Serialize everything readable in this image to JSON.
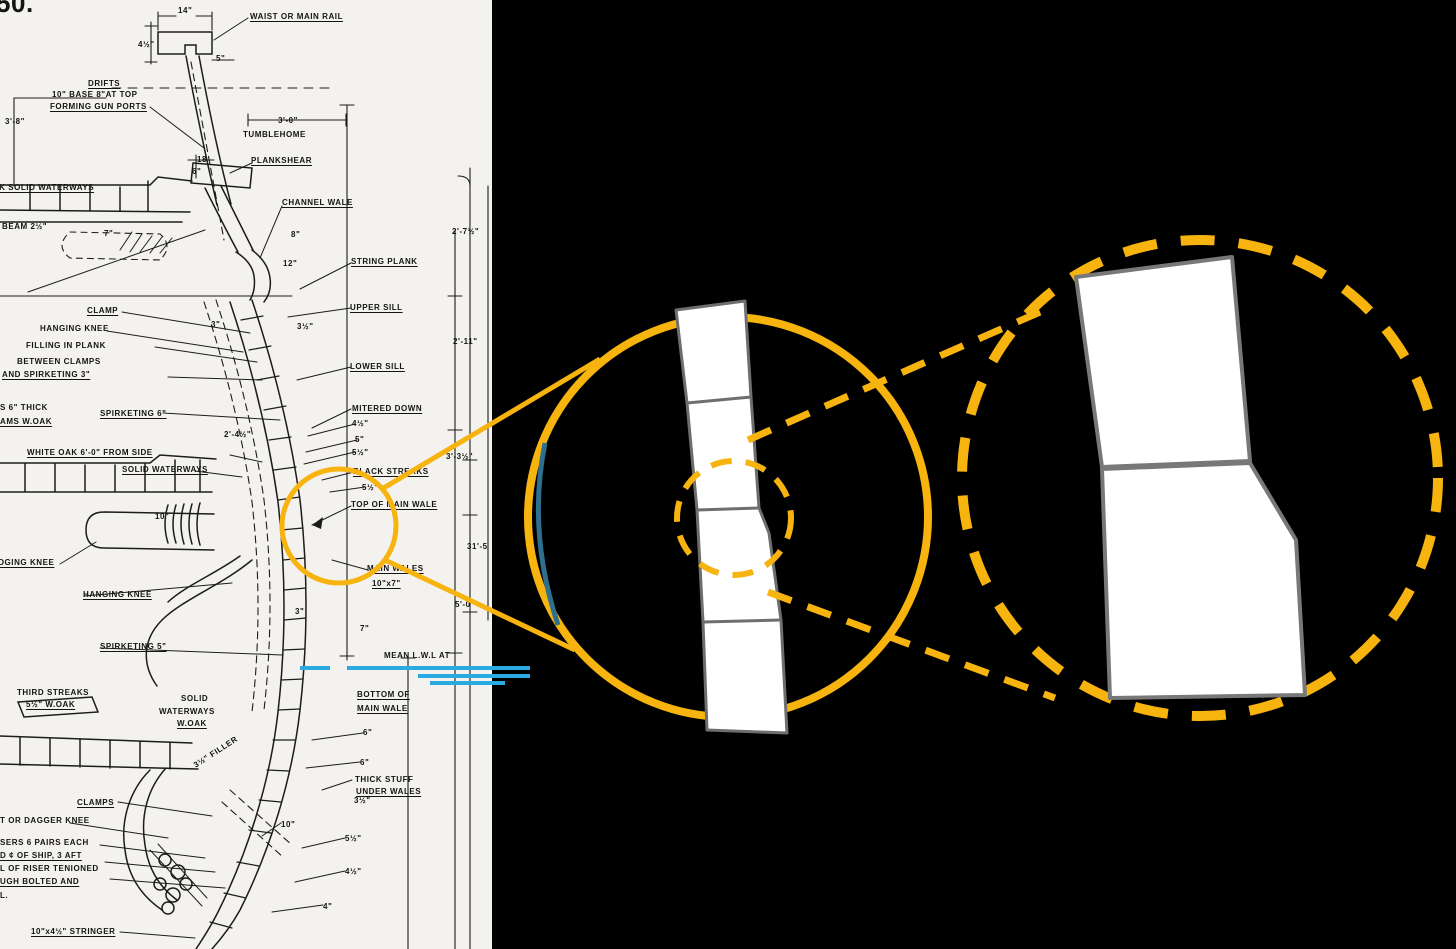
{
  "meta": {
    "description": "Scanned ship midship construction blueprint (hull planking section) with two orange magnification callout circles on black background"
  },
  "colors": {
    "highlight_orange": "#F7B30E",
    "ink": "#1c1c1c",
    "paper": "#f3f2ee",
    "waterline_blue": "#29ABE2",
    "frame_teal": "#2E6F8E",
    "plank_outline": "#6e6e6e",
    "background": "#000000"
  },
  "blueprint": {
    "labels": [
      {
        "t": "50.",
        "x": -4,
        "y": -12,
        "s": 26
      },
      {
        "t": "14\"",
        "x": 178,
        "y": 6
      },
      {
        "t": "WAIST OR MAIN RAIL",
        "x": 250,
        "y": 12,
        "u": true
      },
      {
        "t": "4½\"",
        "x": 138,
        "y": 40
      },
      {
        "t": "5\"",
        "x": 216,
        "y": 54
      },
      {
        "t": "DRIFTS",
        "x": 88,
        "y": 79,
        "u": true
      },
      {
        "t": "10\" BASE 8\"AT TOP",
        "x": 52,
        "y": 90
      },
      {
        "t": "FORMING GUN PORTS",
        "x": 50,
        "y": 102,
        "u": true
      },
      {
        "t": "3'-8\"",
        "x": 5,
        "y": 117
      },
      {
        "t": "3'-0\"",
        "x": 278,
        "y": 116
      },
      {
        "t": "TUMBLEHOME",
        "x": 243,
        "y": 130
      },
      {
        "t": "18",
        "x": 197,
        "y": 155
      },
      {
        "t": "6\"",
        "x": 192,
        "y": 167
      },
      {
        "t": "PLANKSHEAR",
        "x": 251,
        "y": 156,
        "u": true
      },
      {
        "t": "OAK SOLID WATERWAYS",
        "x": -14,
        "y": 183,
        "u": true
      },
      {
        "t": "CHANNEL WALE",
        "x": 282,
        "y": 198,
        "u": true
      },
      {
        "t": "BEAM 2½\"",
        "x": 2,
        "y": 222
      },
      {
        "t": "7\"",
        "x": 104,
        "y": 229
      },
      {
        "t": "8\"",
        "x": 291,
        "y": 230
      },
      {
        "t": "2'-7½\"",
        "x": 452,
        "y": 227
      },
      {
        "t": "12\"",
        "x": 283,
        "y": 259
      },
      {
        "t": "STRING PLANK",
        "x": 351,
        "y": 257,
        "u": true
      },
      {
        "t": "KNEE",
        "x": -26,
        "y": 287
      },
      {
        "t": "CLAMP",
        "x": 87,
        "y": 306,
        "u": true
      },
      {
        "t": "UPPER SILL",
        "x": 350,
        "y": 303,
        "u": true
      },
      {
        "t": "HANGING KNEE",
        "x": 40,
        "y": 324
      },
      {
        "t": "3\"",
        "x": 211,
        "y": 320
      },
      {
        "t": "3½\"",
        "x": 297,
        "y": 322
      },
      {
        "t": "FILLING IN PLANK",
        "x": 26,
        "y": 341
      },
      {
        "t": "2'-11\"",
        "x": 453,
        "y": 337
      },
      {
        "t": "BETWEEN CLAMPS",
        "x": 17,
        "y": 357
      },
      {
        "t": "AND SPIRKETING 3\"",
        "x": 2,
        "y": 370,
        "u": true
      },
      {
        "t": "LOWER SILL",
        "x": 350,
        "y": 362,
        "u": true
      },
      {
        "t": "S 6\" THICK",
        "x": 0,
        "y": 403
      },
      {
        "t": "AMS W.OAK",
        "x": 0,
        "y": 417,
        "u": true
      },
      {
        "t": "SPIRKETING 6\"",
        "x": 100,
        "y": 409,
        "u": true
      },
      {
        "t": "MITERED DOWN",
        "x": 352,
        "y": 404,
        "u": true
      },
      {
        "t": "4½\"",
        "x": 352,
        "y": 419
      },
      {
        "t": "2'-4½\"",
        "x": 224,
        "y": 430
      },
      {
        "t": "5\"",
        "x": 355,
        "y": 435
      },
      {
        "t": "5½\"",
        "x": 352,
        "y": 448
      },
      {
        "t": "WHITE OAK 6'-0\" FROM SIDE",
        "x": 27,
        "y": 448,
        "u": true
      },
      {
        "t": "3'-3½\"",
        "x": 446,
        "y": 452
      },
      {
        "t": "SOLID WATERWAYS",
        "x": 122,
        "y": 465,
        "u": true
      },
      {
        "t": "BLACK STREAKS",
        "x": 353,
        "y": 467,
        "u": true
      },
      {
        "t": "5½\"",
        "x": 362,
        "y": 483
      },
      {
        "t": "TOP OF MAIN WALE",
        "x": 351,
        "y": 500,
        "u": true
      },
      {
        "t": "10\"",
        "x": 155,
        "y": 512
      },
      {
        "t": "LODGING KNEE",
        "x": -14,
        "y": 558,
        "u": true
      },
      {
        "t": "31'-5",
        "x": 467,
        "y": 542
      },
      {
        "t": "MAIN WALES",
        "x": 367,
        "y": 564,
        "u": true
      },
      {
        "t": "10\"x7\"",
        "x": 372,
        "y": 579,
        "u": true
      },
      {
        "t": "HANGING KNEE",
        "x": 83,
        "y": 590,
        "u": true
      },
      {
        "t": "3\"",
        "x": 295,
        "y": 607
      },
      {
        "t": "5'-0\"",
        "x": 455,
        "y": 600
      },
      {
        "t": "7\"",
        "x": 360,
        "y": 624
      },
      {
        "t": "SPIRKETING 5\"",
        "x": 100,
        "y": 642,
        "u": true
      },
      {
        "t": "MEAN L.W.L AT",
        "x": 384,
        "y": 651
      },
      {
        "t": "THIRD STREAKS",
        "x": 17,
        "y": 688
      },
      {
        "t": "5½\" W.OAK",
        "x": 26,
        "y": 700,
        "u": true
      },
      {
        "t": "SOLID",
        "x": 181,
        "y": 694
      },
      {
        "t": "WATERWAYS",
        "x": 159,
        "y": 707
      },
      {
        "t": "W.OAK",
        "x": 177,
        "y": 719,
        "u": true
      },
      {
        "t": "BOTTOM OF",
        "x": 357,
        "y": 690,
        "u": true
      },
      {
        "t": "MAIN WALE",
        "x": 357,
        "y": 704,
        "u": true
      },
      {
        "t": "6\"",
        "x": 363,
        "y": 728
      },
      {
        "t": "6\"",
        "x": 360,
        "y": 758
      },
      {
        "t": "THICK STUFF",
        "x": 355,
        "y": 775
      },
      {
        "t": "UNDER WALES",
        "x": 356,
        "y": 787,
        "u": true
      },
      {
        "t": "3½\"",
        "x": 354,
        "y": 796
      },
      {
        "t": "CLAMPS",
        "x": 77,
        "y": 798,
        "u": true
      },
      {
        "t": "3½\" FILLER",
        "x": 192,
        "y": 762,
        "r": -33
      },
      {
        "t": "T OR DAGGER KNEE",
        "x": 0,
        "y": 816
      },
      {
        "t": "10\"",
        "x": 281,
        "y": 820
      },
      {
        "t": "5½\"",
        "x": 345,
        "y": 834
      },
      {
        "t": "SERS 6 PAIRS EACH",
        "x": 0,
        "y": 838
      },
      {
        "t": "D ¢ OF SHIP, 3 AFT",
        "x": 0,
        "y": 851,
        "u": true
      },
      {
        "t": "L OF RISER TENIONED",
        "x": 0,
        "y": 864
      },
      {
        "t": "UGH BOLTED AND",
        "x": 0,
        "y": 877,
        "u": true
      },
      {
        "t": "L.",
        "x": 0,
        "y": 891
      },
      {
        "t": "4½\"",
        "x": 345,
        "y": 867
      },
      {
        "t": "4\"",
        "x": 323,
        "y": 902
      },
      {
        "t": "10\"x4½\" STRINGER",
        "x": 31,
        "y": 927,
        "u": true
      }
    ]
  }
}
